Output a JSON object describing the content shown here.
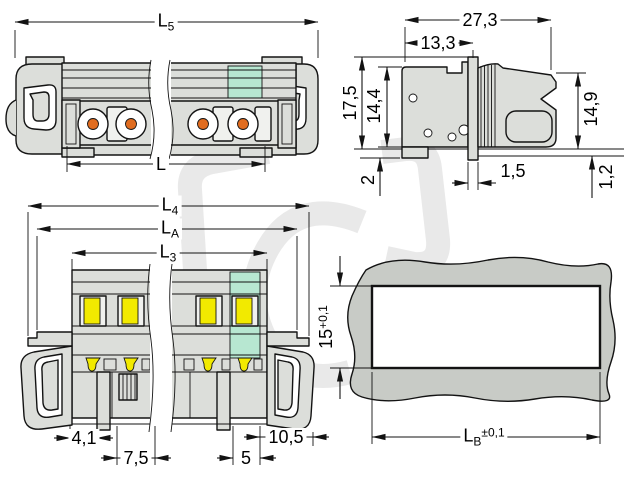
{
  "dims": {
    "l5": {
      "base": "L",
      "sub": "5"
    },
    "l": {
      "base": "L"
    },
    "w27_3": {
      "base": "27,3"
    },
    "w13_3": {
      "base": "13,3"
    },
    "h17_5": {
      "base": "17,5"
    },
    "h14_4": {
      "base": "14,4"
    },
    "h14_9": {
      "base": "14,9"
    },
    "h2": {
      "base": "2"
    },
    "w1_5": {
      "base": "1,5"
    },
    "h1_2": {
      "base": "1,2"
    },
    "l4": {
      "base": "L",
      "sub": "4"
    },
    "la": {
      "base": "L",
      "sub": "A"
    },
    "l3": {
      "base": "L",
      "sub": "3"
    },
    "w4_1": {
      "base": "4,1"
    },
    "w7_5": {
      "base": "7,5"
    },
    "w5": {
      "base": "5"
    },
    "w10_5": {
      "base": "10,5"
    },
    "h15": {
      "base": "15",
      "sup": "+0,1"
    },
    "lb": {
      "base": "L",
      "sub": "B",
      "sup": "±0,1"
    }
  },
  "icons": {
    "watermark": "bracket-c-logo-watermark"
  },
  "colors": {
    "body_gray": "#dcdeda",
    "light_gray": "#f0f1ee",
    "teal": "#b7e7d1",
    "orange": "#e06c1f",
    "yellow": "#f2ea00",
    "panel_gray": "#c8cbc6",
    "outline": "#131313",
    "watermark": "#e9e9e9"
  }
}
